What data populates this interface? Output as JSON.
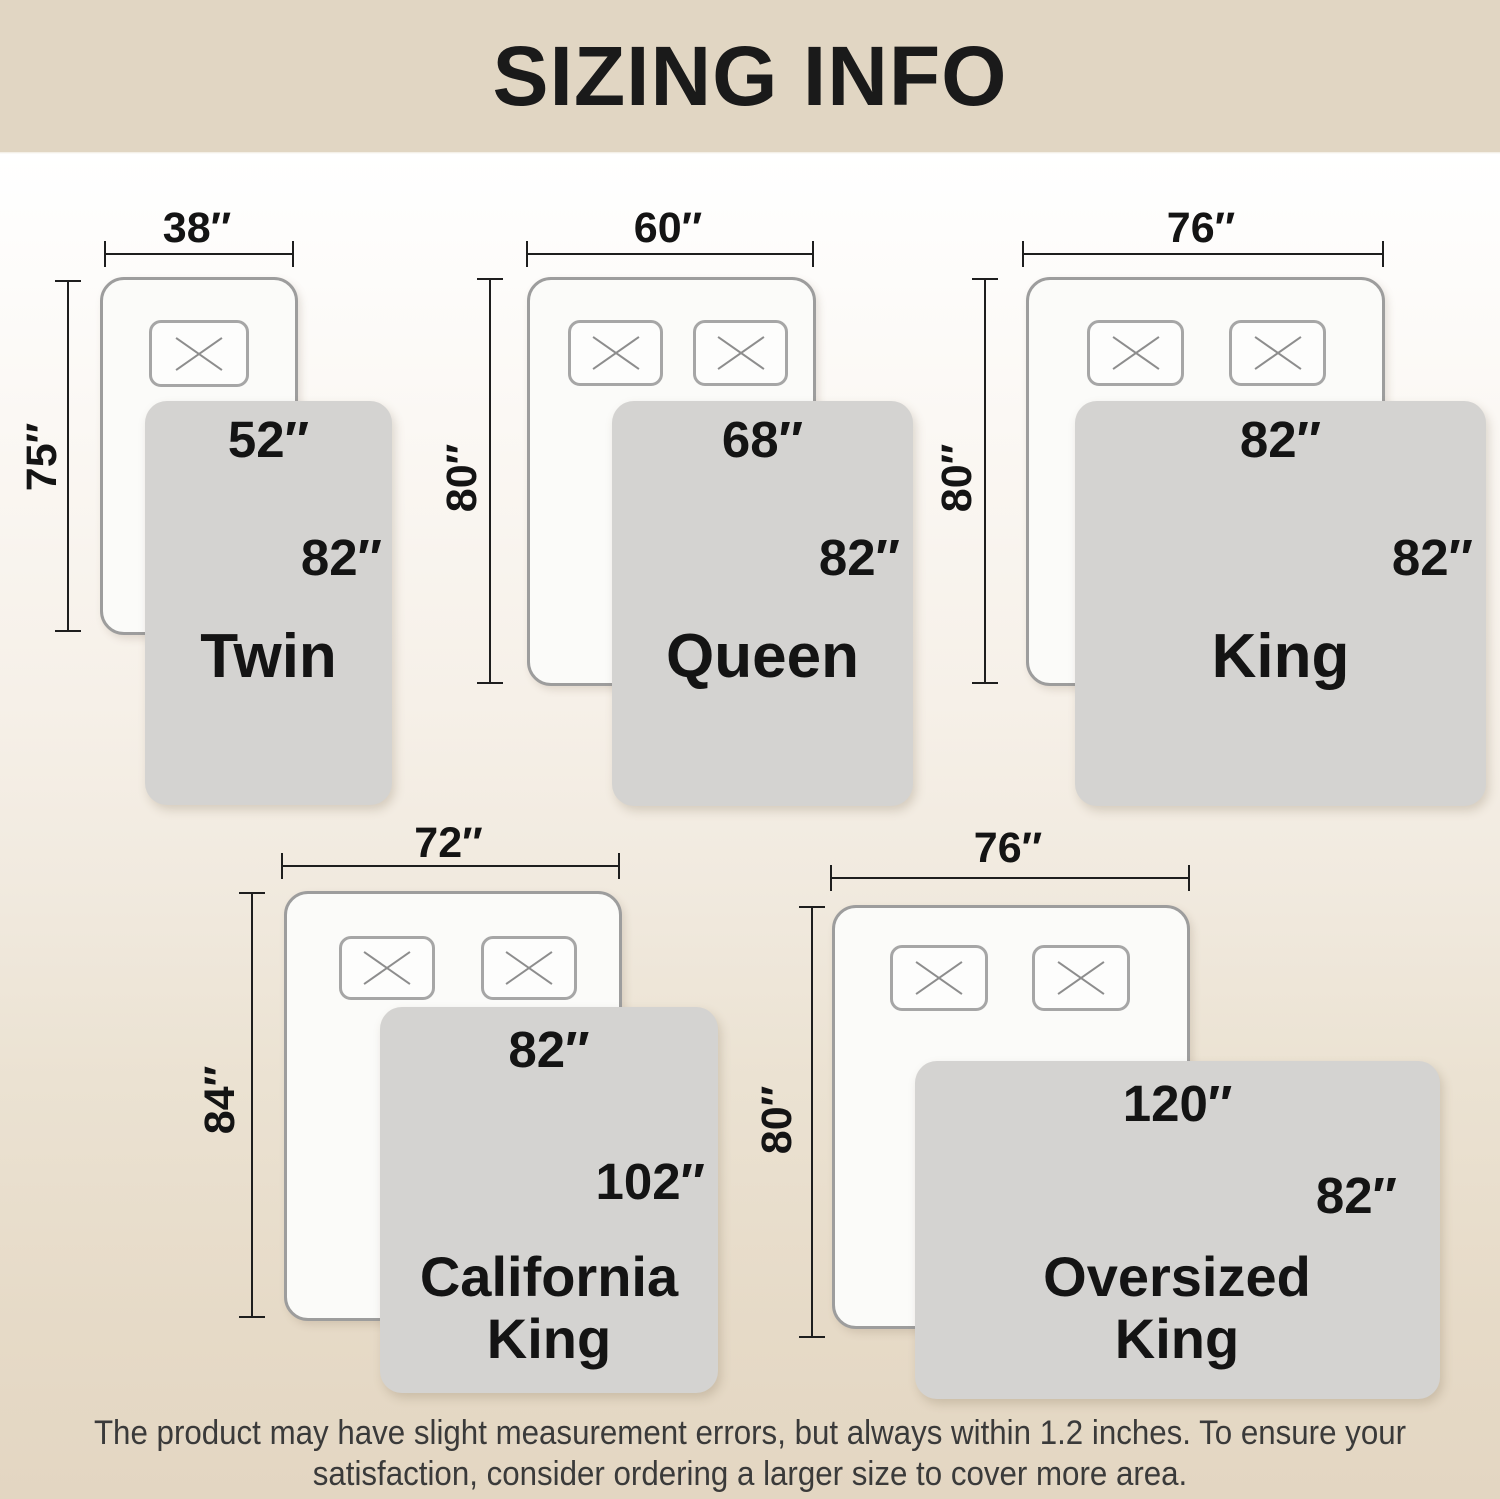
{
  "title": "SIZING INFO",
  "colors": {
    "header_bg": "#e1d6c3",
    "background_top": "#ffffff",
    "background_bottom": "#e3d6c2",
    "blanket": "#d4d3d1",
    "bed_fill": "#fbfbf9",
    "bed_border": "#9d9d9d",
    "text": "#141414"
  },
  "sizes": [
    {
      "id": "twin",
      "name": "Twin",
      "bed_width": "38″",
      "bed_length": "75″",
      "blanket_width": "52″",
      "blanket_length": "82″",
      "pillow_count": 1
    },
    {
      "id": "queen",
      "name": "Queen",
      "bed_width": "60″",
      "bed_length": "80″",
      "blanket_width": "68″",
      "blanket_length": "82″",
      "pillow_count": 2
    },
    {
      "id": "king",
      "name": "King",
      "bed_width": "76″",
      "bed_length": "80″",
      "blanket_width": "82″",
      "blanket_length": "82″",
      "pillow_count": 2
    },
    {
      "id": "california-king",
      "name": "California King",
      "bed_width": "72″",
      "bed_length": "84″",
      "blanket_width": "82″",
      "blanket_length": "102″",
      "pillow_count": 2
    },
    {
      "id": "oversized-king",
      "name": "Oversized King",
      "bed_width": "76″",
      "bed_length": "80″",
      "blanket_width": "120″",
      "blanket_length": "82″",
      "pillow_count": 2
    }
  ],
  "footer": {
    "lines": [
      "The product may have slight measurement errors, but always within 1.2 inches. To ensure your",
      "satisfaction, consider ordering a larger size to cover more area."
    ]
  }
}
